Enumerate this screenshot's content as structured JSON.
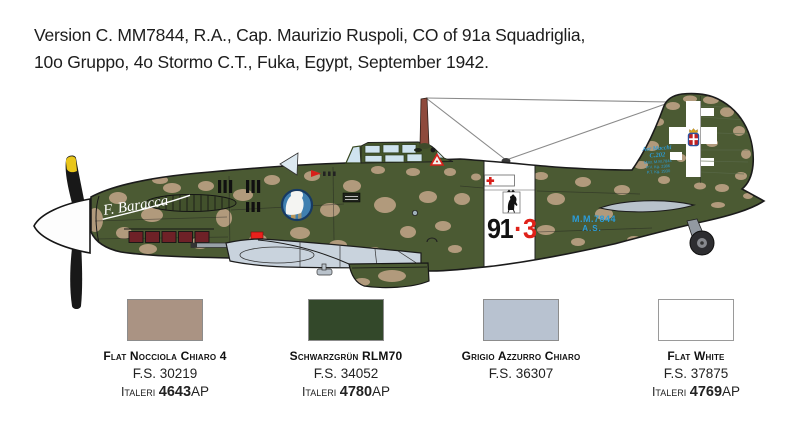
{
  "header": {
    "line1": "Version C. MM7844, R.A., Cap. Maurizio Ruspoli, CO of 91a Squadriglia,",
    "line2": "10o Gruppo, 4o Stormo C.T., Fuka, Egypt, September 1942."
  },
  "aircraft": {
    "nose_art": "F. Baracca",
    "code": {
      "squadron": "91",
      "separator": "·",
      "individual": "3"
    },
    "serial": [
      "M.M.7844",
      "A.S."
    ],
    "stencil": [
      "Aer Macchi",
      "C.202",
      "Matr. M.M.7844",
      "P.V. Kg. 2386",
      "P.T. Kg. 2930"
    ],
    "colors": {
      "camo_green": "#4b5a33",
      "camo_tan": "#b19a7c",
      "underside_gray": "#c9d3dd",
      "canopy_glass": "#cfe3ef",
      "marking_blue": "#2b9cd8",
      "code_red": "#df2119",
      "band_white": "#ffffff",
      "prop_yellow": "#e9c61b",
      "exhaust_red": "#6e2127",
      "roundel_blue": "#3f7fb0"
    }
  },
  "palette": [
    {
      "name": "Flat Nocciola Chiaro 4",
      "fs": "F.S. 30219",
      "brand": "Italeri",
      "code": "4643",
      "suffix": "AP",
      "hex": "#aa9383"
    },
    {
      "name": "Schwarzgrün RLM70",
      "fs": "F.S. 34052",
      "brand": "Italeri",
      "code": "4780",
      "suffix": "AP",
      "hex": "#33482a"
    },
    {
      "name": "Grigio Azzurro Chiaro",
      "fs": "F.S. 36307",
      "brand": "",
      "code": "",
      "suffix": "",
      "hex": "#b8c2d0"
    },
    {
      "name": "Flat White",
      "fs": "F.S. 37875",
      "brand": "Italeri",
      "code": "4769",
      "suffix": "AP",
      "hex": "#ffffff"
    }
  ]
}
